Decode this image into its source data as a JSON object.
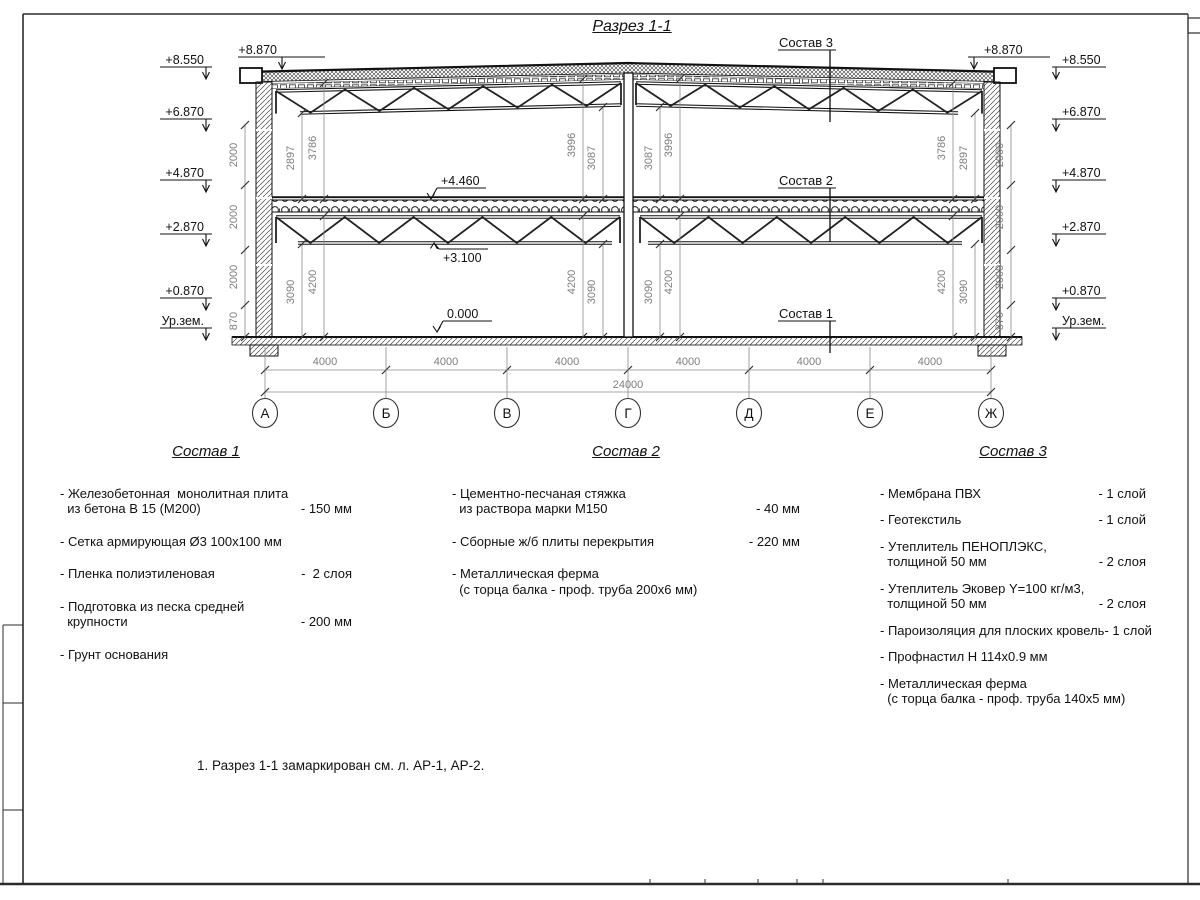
{
  "title": "Разрез 1-1",
  "section": {
    "marks_left": [
      "+8.550",
      "+6.870",
      "+4.870",
      "+2.870",
      "+0.870",
      "Ур.зем."
    ],
    "marks_right": [
      "+8.550",
      "+6.870",
      "+4.870",
      "+2.870",
      "+0.870",
      "Ур.зем."
    ],
    "mark_top_left": "+8.870",
    "mark_top_right": "+8.870",
    "mark_floor2": "+4.460",
    "mark_truss2": "+3.100",
    "mark_zero": "0.000",
    "leader_sostav1": "Состав 1",
    "leader_sostav2": "Состав 2",
    "leader_sostav3": "Состав 3",
    "vdims_left": [
      "2000",
      "2000",
      "2000",
      "870"
    ],
    "vdims_right": [
      "2000",
      "2000",
      "2000",
      "870"
    ],
    "vdims_upper": [
      "2897",
      "3786",
      "3996",
      "3087",
      "3087",
      "3996",
      "3786",
      "2897"
    ],
    "vdims_lower": [
      "3090",
      "4200",
      "4200",
      "3090",
      "3090",
      "4200",
      "4200",
      "3090"
    ]
  },
  "axes": {
    "labels": [
      "А",
      "Б",
      "В",
      "Г",
      "Д",
      "Е",
      "Ж"
    ],
    "bay_dims": [
      "4000",
      "4000",
      "4000",
      "4000",
      "4000",
      "4000"
    ],
    "total_dim": "24000"
  },
  "legends": [
    {
      "title": "Состав 1",
      "items": [
        {
          "name": "- Железобетонная  монолитная плита\n  из бетона В 15 (М200)",
          "value": "- 150 мм"
        },
        {
          "name": "- Сетка армирующая Ø3 100x100 мм",
          "value": ""
        },
        {
          "name": "- Пленка полиэтиленовая",
          "value": "-  2 слоя"
        },
        {
          "name": "- Подготовка из песка средней\n  крупности",
          "value": "- 200 мм"
        },
        {
          "name": "- Грунт основания",
          "value": ""
        }
      ]
    },
    {
      "title": "Состав 2",
      "items": [
        {
          "name": "- Цементно-песчаная стяжка\n  из раствора марки М150",
          "value": "- 40 мм"
        },
        {
          "name": "- Сборные ж/б плиты перекрытия",
          "value": "- 220 мм"
        },
        {
          "name": "- Металлическая ферма\n  (с торца балка - проф. труба 200x6 мм)",
          "value": ""
        }
      ]
    },
    {
      "title": "Состав 3",
      "items": [
        {
          "name": "- Мембрана ПВХ",
          "value": "- 1 слой"
        },
        {
          "name": "- Геотекстиль",
          "value": "- 1 слой"
        },
        {
          "name": "- Утеплитель ПЕНОПЛЭКС,\n  толщиной 50 мм",
          "value": "- 2 слоя"
        },
        {
          "name": "- Утеплитель Эковер Y=100 кг/м3,\n  толщиной 50 мм",
          "value": "- 2 слоя"
        },
        {
          "name": "- Пароизоляция для плоских кровель",
          "value": "- 1 слой"
        },
        {
          "name": "- Профнастил Н 114x0.9 мм",
          "value": ""
        },
        {
          "name": "- Металлическая ферма\n  (с торца балка - проф. труба 140х5 мм)",
          "value": ""
        }
      ]
    }
  ],
  "note": "1. Разрез 1-1 замаркирован см. л. АР-1, АР-2."
}
